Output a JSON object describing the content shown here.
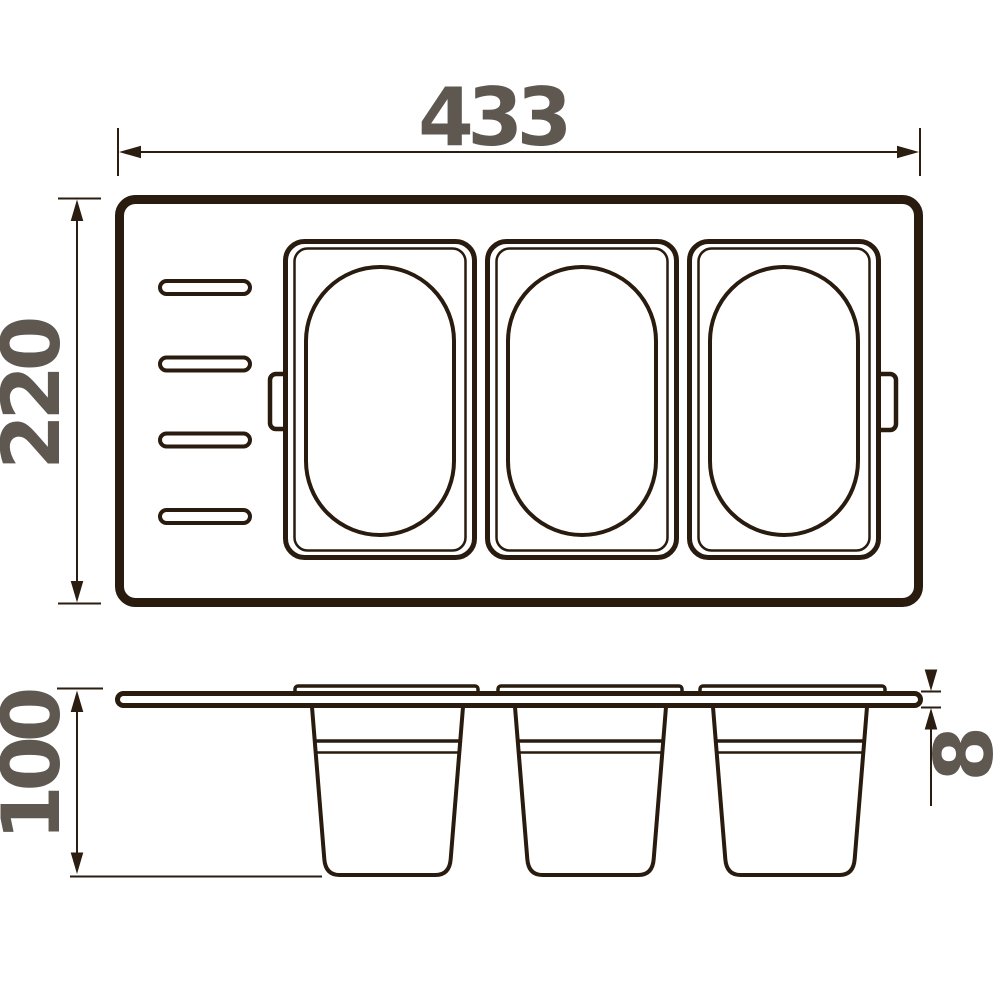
{
  "dimensions": {
    "width": "433",
    "height": "220",
    "depth": "100",
    "thickness": "8"
  },
  "colors": {
    "line": "#291b0e",
    "dimension_line": "#2b1d10",
    "label": "#5e5850",
    "background": "#ffffff"
  },
  "structure": {
    "compartments": 3,
    "side_slots": 4,
    "containers": 3,
    "mount_tabs": 2
  }
}
